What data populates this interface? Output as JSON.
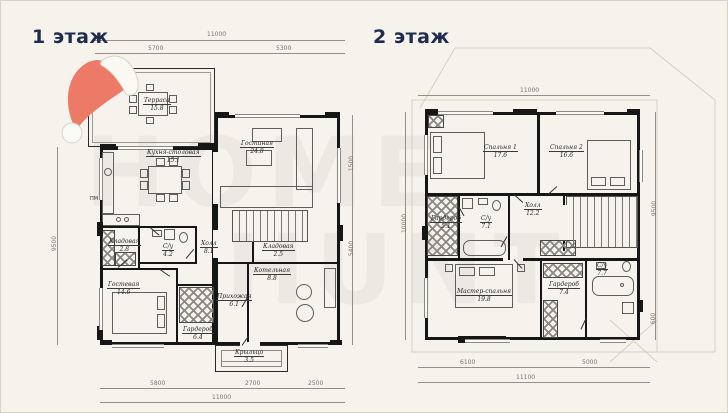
{
  "colors": {
    "background": "#f5f3ec",
    "title": "#202c4e",
    "hat": "#ec7a67",
    "hat_trim": "#fbf9f3",
    "walls": "#161616",
    "dims": "#968f82"
  },
  "watermark": {
    "line1": "HOME",
    "line2": "HUNT"
  },
  "floor1": {
    "title": "1 этаж",
    "notes": {
      "appliance": "ПМ"
    },
    "rooms": [
      {
        "name": "Терраса",
        "area": "15.8"
      },
      {
        "name": "Кухня-столовая",
        "area": "15.1"
      },
      {
        "name": "Гостиная",
        "area": "24.8"
      },
      {
        "name": "Кладовая",
        "area": "2.8"
      },
      {
        "name": "С/у",
        "area": "4.2"
      },
      {
        "name": "Холл",
        "area": "8.1"
      },
      {
        "name": "Кладовая",
        "area": "2.5"
      },
      {
        "name": "Котельная",
        "area": "8.8"
      },
      {
        "name": "Гостевая",
        "area": "14.6"
      },
      {
        "name": "Прихожая",
        "area": "6.1"
      },
      {
        "name": "Гардероб",
        "area": "6.4"
      },
      {
        "name": "Крыльцо",
        "area": "3.5"
      }
    ],
    "dims": {
      "top_total": "11000",
      "top_left": "5700",
      "top_right": "5300",
      "bottom_left": "5800",
      "bottom_mid": "2700",
      "bottom_right": "2500",
      "bottom_total": "11000",
      "left_total": "9500",
      "right_upper": "1500",
      "right_lower": "5400"
    }
  },
  "floor2": {
    "title": "2 этаж",
    "rooms": [
      {
        "name": "Спальня 1",
        "area": "17.6"
      },
      {
        "name": "Спальня 2",
        "area": "16.6"
      },
      {
        "name": "Гардероб",
        "area": "5.1"
      },
      {
        "name": "С/у",
        "area": "7.1"
      },
      {
        "name": "Холл",
        "area": "12.2"
      },
      {
        "name": "Мастер-спальня",
        "area": "19.8"
      },
      {
        "name": "Гардероб",
        "area": "7.4"
      },
      {
        "name": "С/у",
        "area": "7.7"
      }
    ],
    "dims": {
      "top_total": "11000",
      "left_total": "10000",
      "right_total": "9500",
      "right_lower": "600",
      "bottom_left": "6100",
      "bottom_right": "5000",
      "bottom_total": "11100"
    }
  }
}
